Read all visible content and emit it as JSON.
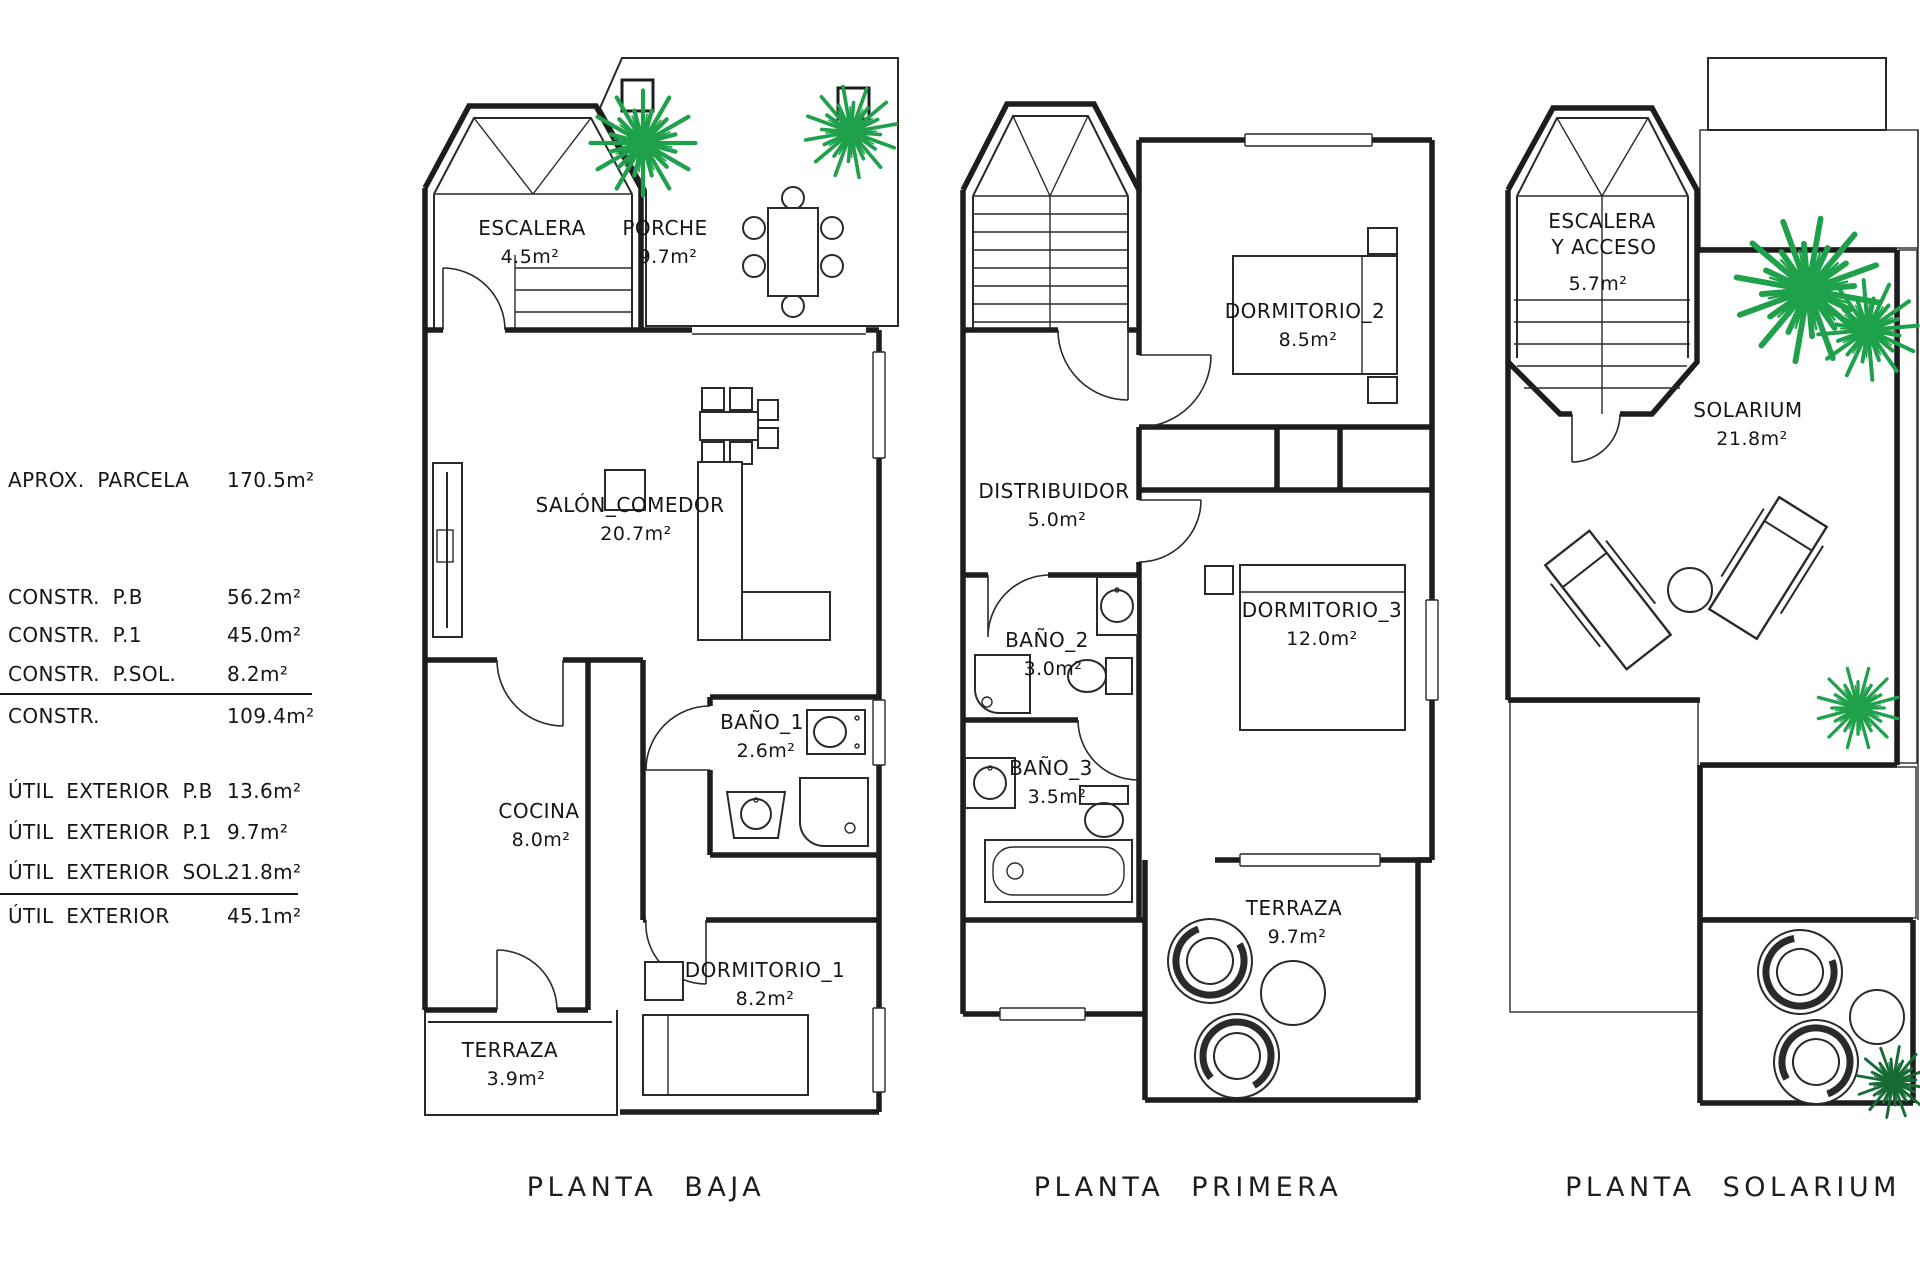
{
  "legend": {
    "rows": [
      {
        "label": "APROX. PARCELA",
        "value": "170.5m²"
      },
      {
        "label": "CONSTR.  P.B",
        "value": "56.2m²"
      },
      {
        "label": "CONSTR.  P.1",
        "value": "45.0m²"
      },
      {
        "label": "CONSTR.  P.SOL.",
        "value": "8.2m²"
      },
      {
        "label": "CONSTR.",
        "value": "109.4m²"
      },
      {
        "label": "ÚTIL EXTERIOR P.B",
        "value": "13.6m²"
      },
      {
        "label": "ÚTIL EXTERIOR P.1",
        "value": "9.7m²"
      },
      {
        "label": "ÚTIL EXTERIOR SOL.",
        "value": "21.8m²"
      },
      {
        "label": "ÚTIL EXTERIOR",
        "value": "45.1m²"
      }
    ]
  },
  "plans": [
    {
      "caption": "PLANTA  BAJA",
      "rooms": [
        {
          "name": "ESCALERA",
          "area": "4.5m²"
        },
        {
          "name": "PORCHE",
          "area": "9.7m²"
        },
        {
          "name": "SALÓN_COMEDOR",
          "area": "20.7m²"
        },
        {
          "name": "COCINA",
          "area": "8.0m²"
        },
        {
          "name": "BAÑO_1",
          "area": "2.6m²"
        },
        {
          "name": "DORMITORIO_1",
          "area": "8.2m²"
        },
        {
          "name": "TERRAZA",
          "area": "3.9m²"
        }
      ]
    },
    {
      "caption": "PLANTA  PRIMERA",
      "rooms": [
        {
          "name": "DORMITORIO_2",
          "area": "8.5m²"
        },
        {
          "name": "DISTRIBUIDOR",
          "area": "5.0m²"
        },
        {
          "name": "BAÑO_2",
          "area": "3.0m²"
        },
        {
          "name": "DORMITORIO_3",
          "area": "12.0m²"
        },
        {
          "name": "BAÑO_3",
          "area": "3.5m²"
        },
        {
          "name": "TERRAZA",
          "area": "9.7m²"
        }
      ]
    },
    {
      "caption": "PLANTA  SOLARIUM",
      "rooms": [
        {
          "line1": "ESCALERA",
          "line2": "Y ACCESO",
          "area": "5.7m²"
        },
        {
          "name": "SOLARIUM",
          "area": "21.8m²"
        }
      ]
    }
  ],
  "colors": {
    "wall": "#1d1d1f",
    "plant_green": "#1fa14b",
    "plant_dark": "#166b34"
  }
}
